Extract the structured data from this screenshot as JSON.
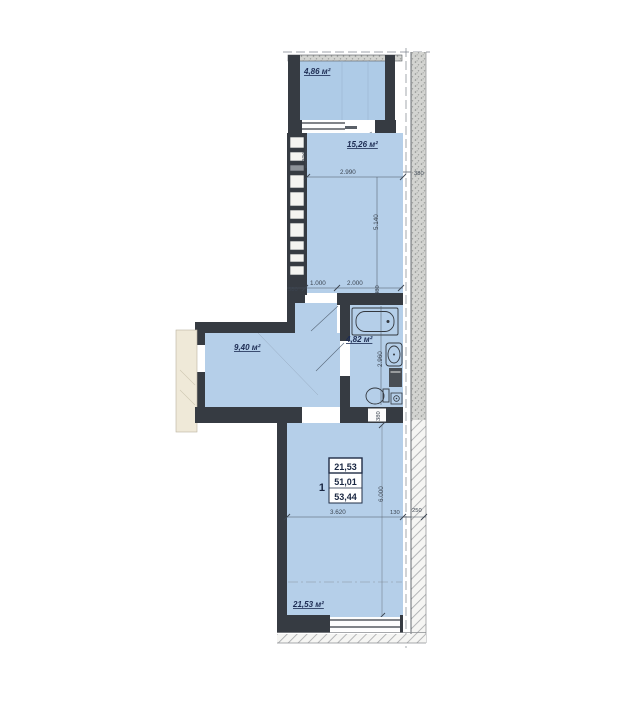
{
  "floorplan": {
    "rooms": {
      "balcony": "4,86 м²",
      "kitchen_living": "15,26 м²",
      "hallway": "9,40 м²",
      "bathroom": "4,82 м²",
      "bedroom": "21,53 м²"
    },
    "apartment_stamp": {
      "number": "1",
      "living_area": "21,53",
      "apartment_area": "51,01",
      "total_area": "53,44"
    },
    "dimensions": {
      "balcony_opening": "770",
      "kitchen_width": "2.990",
      "kitchen_length": "5.140",
      "right_wall_top": "380",
      "bottom_left_wall": "380",
      "bottom_opening": "1.000",
      "bottom_span": "2.000",
      "bottom_right_wall": "380",
      "bathroom_length": "2.960",
      "bathroom_wall": "380",
      "bedroom_length": "6.000",
      "bedroom_width": "3.620",
      "offset": "130",
      "outer_wall": "250"
    },
    "colors": {
      "room_fill": "#b5cfe9",
      "wall": "#363b42",
      "stair_area": "#efe9d8"
    }
  }
}
